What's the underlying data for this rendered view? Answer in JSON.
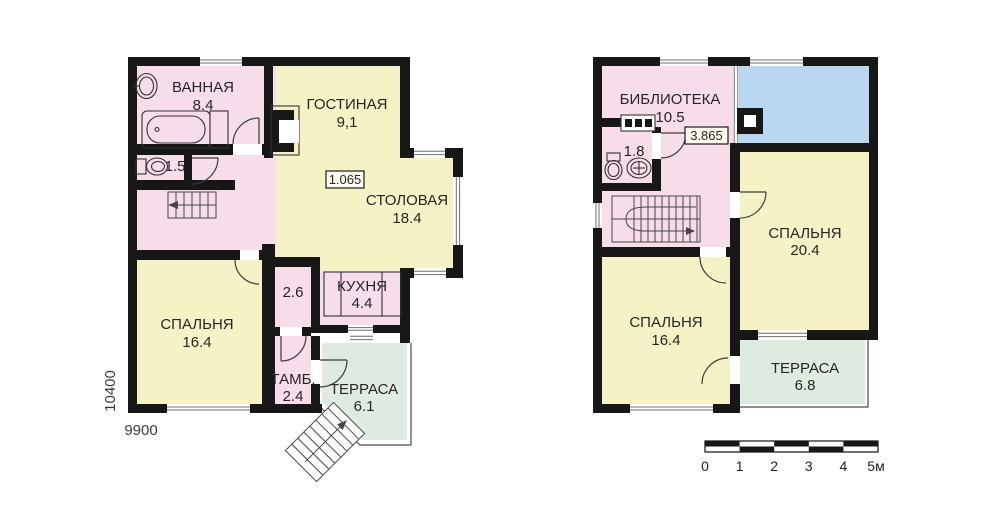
{
  "colors": {
    "pink": "#f7dcea",
    "yellow": "#f5f2c6",
    "green": "#dfeae0",
    "blue": "#b9d7f1",
    "wall": "#171717"
  },
  "floor1": {
    "bathroom": {
      "name": "ВАННАЯ",
      "area": "8.4"
    },
    "wc_area": "1.5",
    "living": {
      "name": "ГОСТИНАЯ",
      "area": "9,1"
    },
    "dining": {
      "name": "СТОЛОВАЯ",
      "area": "18.4"
    },
    "level_mark": "1.065",
    "hall_area": "2.6",
    "kitchen": {
      "name": "КУХНЯ",
      "area": "4.4"
    },
    "bedroom": {
      "name": "СПАЛЬНЯ",
      "area": "16.4"
    },
    "vestibule": {
      "name": "ТАМБ.",
      "area": "2.4"
    },
    "terrace": {
      "name": "ТЕРРАСА",
      "area": "6.1"
    },
    "dim_vertical": "10400",
    "dim_horizontal": "9900"
  },
  "floor2": {
    "library": {
      "name": "БИБЛИОТЕКА",
      "area": "10.5"
    },
    "wc_area": "1.8",
    "level_mark": "3.865",
    "bedroom_right": {
      "name": "СПАЛЬНЯ",
      "area": "20.4"
    },
    "bedroom_left": {
      "name": "СПАЛЬНЯ",
      "area": "16.4"
    },
    "terrace": {
      "name": "ТЕРРАСА",
      "area": "6.8"
    }
  },
  "scalebar": {
    "ticks": [
      "0",
      "1",
      "2",
      "3",
      "4",
      "5м"
    ]
  }
}
